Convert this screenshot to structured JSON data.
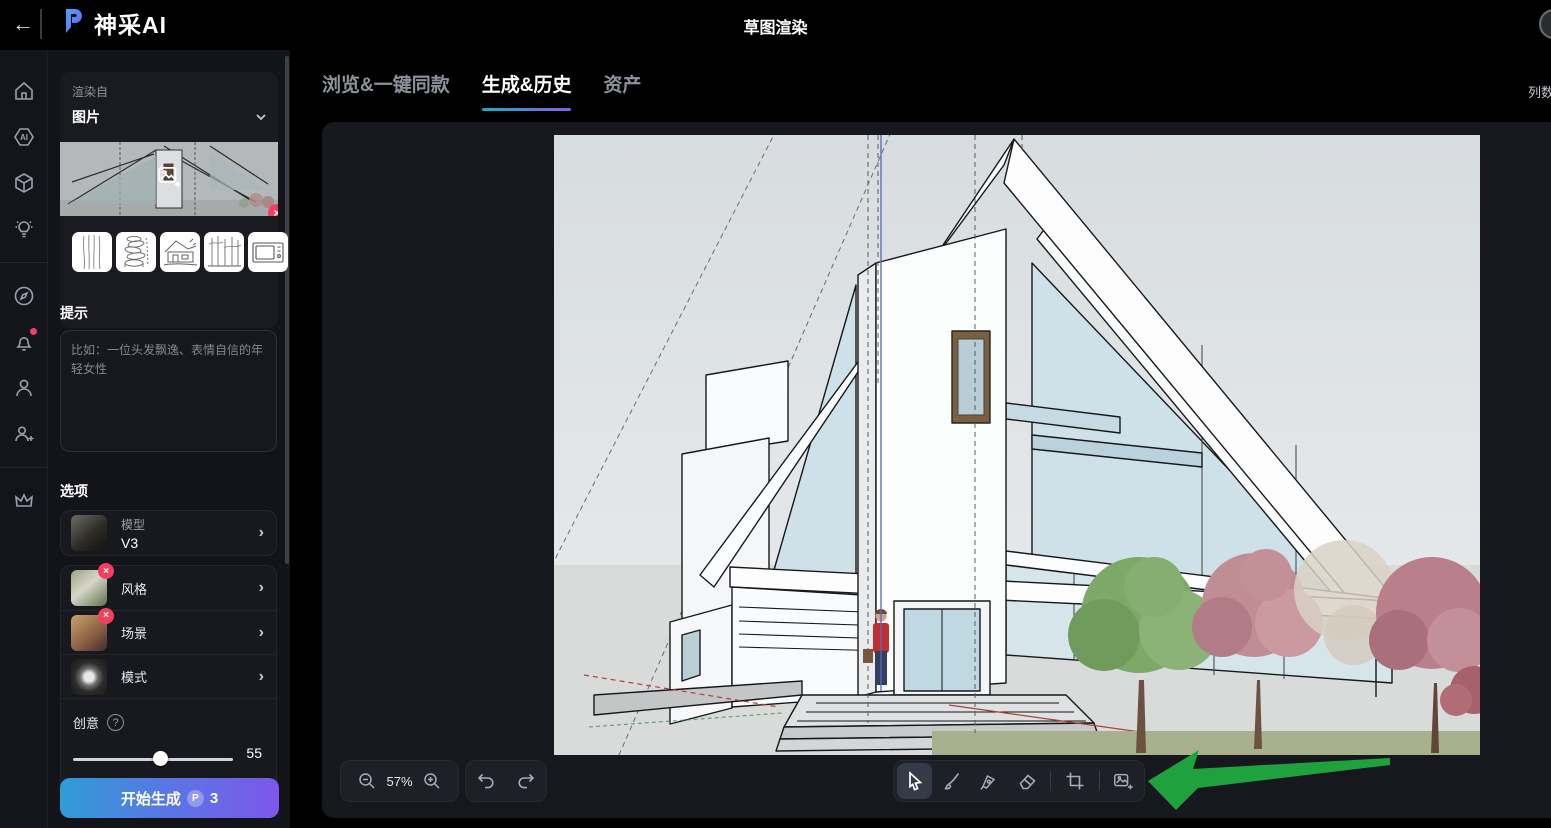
{
  "topbar": {
    "logo_text": "神采AI",
    "title": "草图渲染",
    "back_glyph": "←"
  },
  "rail": {
    "items": [
      "home",
      "ai-tools",
      "3d-models",
      "inspiration",
      "explore",
      "notifications",
      "profile",
      "invite",
      "membership"
    ],
    "notification_badge": true
  },
  "left_panel": {
    "render_from_label": "渲染自",
    "source_value": "图片",
    "prompt_label": "提示",
    "prompt_placeholder": "比如：一位头发飘逸、表情自信的年轻女性",
    "options_label": "选项",
    "model": {
      "label": "模型",
      "value": "V3"
    },
    "style": {
      "label": "风格"
    },
    "scene": {
      "label": "场景"
    },
    "mode": {
      "label": "模式"
    },
    "creativity": {
      "label": "创意",
      "value": "55"
    },
    "generate_label": "开始生成",
    "generate_cost": "3",
    "coin_glyph": "P"
  },
  "tabs": [
    {
      "label": "浏览&一键同款",
      "active": false
    },
    {
      "label": "生成&历史",
      "active": true
    },
    {
      "label": "资产",
      "active": false
    }
  ],
  "main": {
    "columns_label": "列数"
  },
  "toolbar": {
    "zoom_level": "57%",
    "tools": [
      "cursor",
      "brush",
      "pen",
      "eraser",
      "crop",
      "add-image"
    ]
  },
  "glyphs": {
    "help": "?",
    "close": "×",
    "chevron_right": "›"
  },
  "colors": {
    "badge_red": "#f43f5e",
    "arrow_green": "#1fa23d",
    "button_gradient_start": "#309cd6",
    "button_gradient_end": "#7e57ea",
    "tab_underline_start": "#10b3c8",
    "tab_underline_end": "#8a5bf0"
  }
}
